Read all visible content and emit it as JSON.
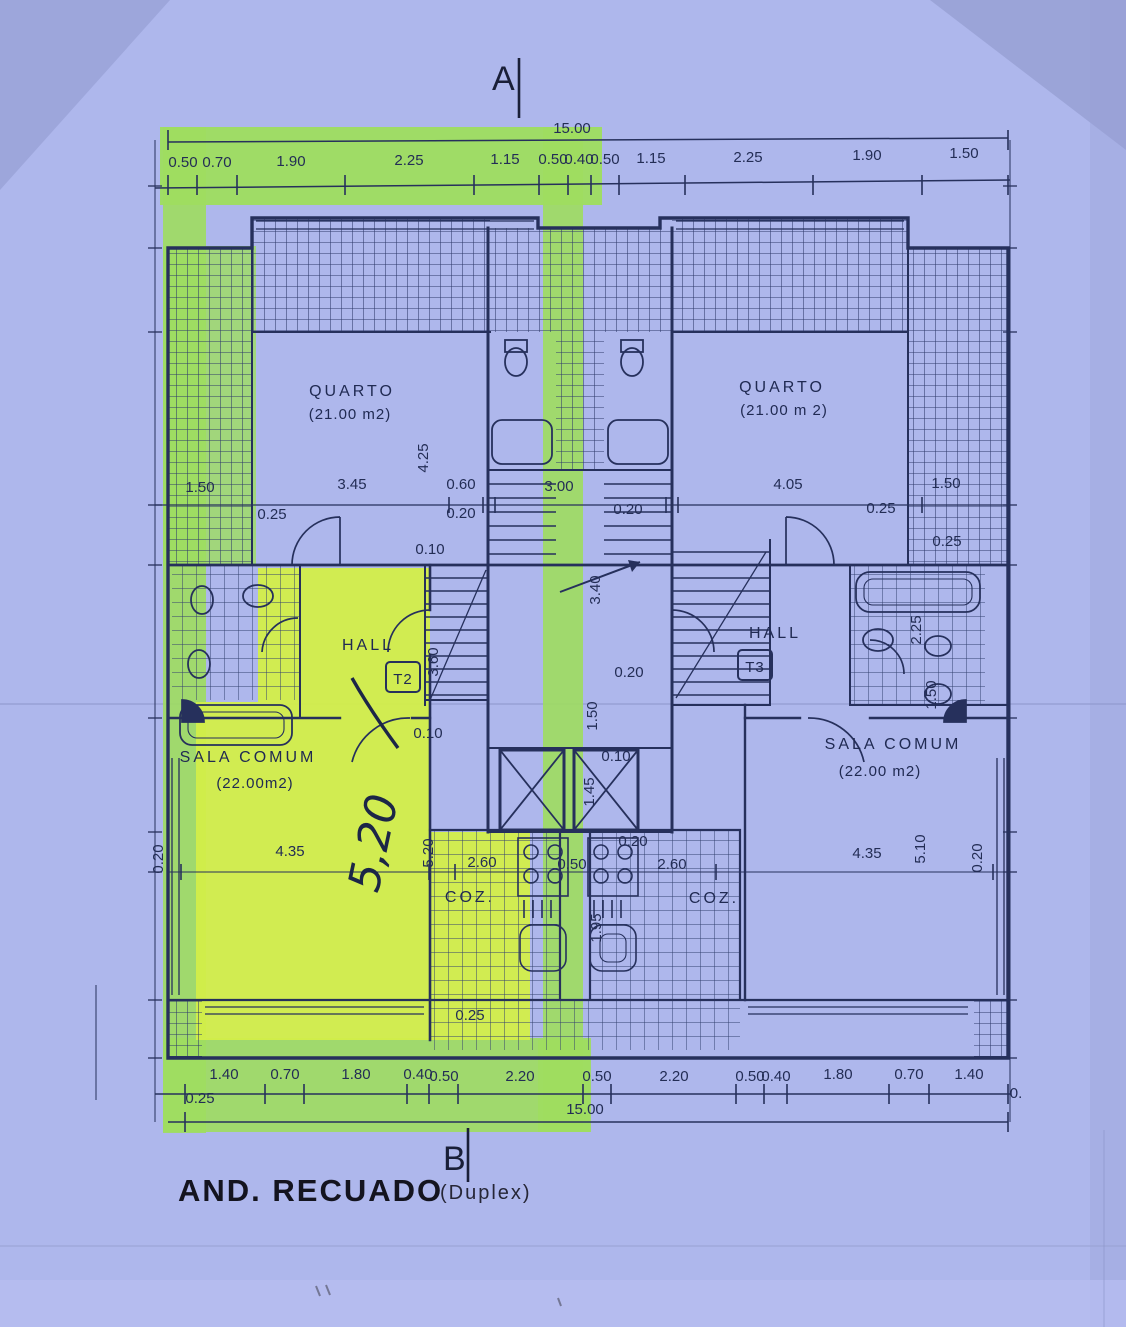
{
  "meta": {
    "drawing_title": "AND. RECUADO",
    "drawing_subtitle": "(Duplex)",
    "section_marker_top": "A",
    "section_marker_bottom": "B"
  },
  "colors": {
    "paper": "#aeb7ec",
    "ink": "#26305c",
    "title_ink": "#14141f",
    "highlighter_green": "#9edd5f",
    "highlighter_yellow": "#d3ee49"
  },
  "rooms": {
    "quarto_left": {
      "name": "QUARTO",
      "area": "(21.00 m2)"
    },
    "quarto_right": {
      "name": "QUARTO",
      "area": "(21.00 m 2)"
    },
    "hall_left": {
      "name": "HALL",
      "tag": "T2"
    },
    "hall_right": {
      "name": "HALL",
      "tag": "T3"
    },
    "sala_left": {
      "name": "SALA COMUM",
      "area": "(22.00m2)"
    },
    "sala_right": {
      "name": "SALA COMUM",
      "area": "(22.00 m2)"
    },
    "coz_left": {
      "name": "COZ."
    },
    "coz_right": {
      "name": "COZ."
    }
  },
  "handwriting": {
    "dim": "5,20"
  },
  "dims": {
    "top_total": "15.00",
    "bottom_total": "15.00",
    "labels": [
      {
        "t": "0.50",
        "x": 183,
        "y": 167,
        "fs": 14
      },
      {
        "t": "0.70",
        "x": 217,
        "y": 167,
        "fs": 14
      },
      {
        "t": "1.90",
        "x": 291,
        "y": 166
      },
      {
        "t": "2.25",
        "x": 409,
        "y": 165
      },
      {
        "t": "1.15",
        "x": 505,
        "y": 164
      },
      {
        "t": "0.50",
        "x": 553,
        "y": 164,
        "fs": 13
      },
      {
        "t": "0.40",
        "x": 579,
        "y": 164,
        "fs": 13
      },
      {
        "t": "0.50",
        "x": 605,
        "y": 164,
        "fs": 13
      },
      {
        "t": "1.15",
        "x": 651,
        "y": 163
      },
      {
        "t": "2.25",
        "x": 748,
        "y": 162
      },
      {
        "t": "1.90",
        "x": 867,
        "y": 160
      },
      {
        "t": "1.50",
        "x": 964,
        "y": 158
      },
      {
        "t": "1.50",
        "x": 200,
        "y": 492,
        "fs": 13
      },
      {
        "t": "0.25",
        "x": 272,
        "y": 519,
        "fs": 13
      },
      {
        "t": "3.45",
        "x": 352,
        "y": 489
      },
      {
        "t": "0.60",
        "x": 461,
        "y": 489,
        "fs": 13
      },
      {
        "t": "0.20",
        "x": 461,
        "y": 518,
        "fs": 13
      },
      {
        "t": "3.00",
        "x": 559,
        "y": 491
      },
      {
        "t": "0.20",
        "x": 628,
        "y": 514,
        "fs": 13
      },
      {
        "t": "4.05",
        "x": 788,
        "y": 489
      },
      {
        "t": "0.25",
        "x": 881,
        "y": 513,
        "fs": 13
      },
      {
        "t": "1.50",
        "x": 946,
        "y": 488,
        "fs": 13
      },
      {
        "t": "0.25",
        "x": 947,
        "y": 546,
        "fs": 12
      },
      {
        "t": "4.25",
        "x": 428,
        "y": 458,
        "r": -90
      },
      {
        "t": "0.10",
        "x": 430,
        "y": 554,
        "fs": 13
      },
      {
        "t": "3.40",
        "x": 600,
        "y": 590,
        "r": -90,
        "fs": 14
      },
      {
        "t": "3.60",
        "x": 438,
        "y": 662,
        "r": -90,
        "fs": 13
      },
      {
        "t": "0.20",
        "x": 629,
        "y": 677,
        "fs": 13
      },
      {
        "t": "1.50",
        "x": 597,
        "y": 716,
        "r": -90,
        "fs": 14
      },
      {
        "t": "0.10",
        "x": 616,
        "y": 761,
        "fs": 12
      },
      {
        "t": "1.45",
        "x": 594,
        "y": 792,
        "r": -90,
        "fs": 12
      },
      {
        "t": "2.25",
        "x": 921,
        "y": 630,
        "r": -90,
        "fs": 13
      },
      {
        "t": "1.50",
        "x": 936,
        "y": 695,
        "r": -90,
        "fs": 12
      },
      {
        "t": "0.10",
        "x": 428,
        "y": 738,
        "fs": 12
      },
      {
        "t": "0.20",
        "x": 163,
        "y": 859,
        "r": -90,
        "fs": 12
      },
      {
        "t": "4.35",
        "x": 290,
        "y": 856
      },
      {
        "t": "5.20",
        "x": 433,
        "y": 853,
        "r": -90,
        "fs": 13
      },
      {
        "t": "2.60",
        "x": 482,
        "y": 867,
        "fs": 14
      },
      {
        "t": "0.50",
        "x": 572,
        "y": 869,
        "fs": 12
      },
      {
        "t": "0.20",
        "x": 633,
        "y": 846,
        "fs": 12
      },
      {
        "t": "2.60",
        "x": 672,
        "y": 869,
        "fs": 14
      },
      {
        "t": "1.95",
        "x": 601,
        "y": 928,
        "r": -90,
        "fs": 12
      },
      {
        "t": "4.35",
        "x": 867,
        "y": 858
      },
      {
        "t": "5.10",
        "x": 925,
        "y": 849,
        "r": -90,
        "fs": 13
      },
      {
        "t": "0.20",
        "x": 982,
        "y": 858,
        "r": -90,
        "fs": 12
      },
      {
        "t": "0.25",
        "x": 470,
        "y": 1020,
        "fs": 13
      },
      {
        "t": "1.40",
        "x": 224,
        "y": 1079
      },
      {
        "t": "0.70",
        "x": 285,
        "y": 1079
      },
      {
        "t": "1.80",
        "x": 356,
        "y": 1079
      },
      {
        "t": "0.40",
        "x": 418,
        "y": 1079,
        "fs": 13
      },
      {
        "t": "0.50",
        "x": 444,
        "y": 1081,
        "fs": 13
      },
      {
        "t": "2.20",
        "x": 520,
        "y": 1081
      },
      {
        "t": "0.50",
        "x": 597,
        "y": 1081,
        "fs": 13
      },
      {
        "t": "2.20",
        "x": 674,
        "y": 1081
      },
      {
        "t": "0.50",
        "x": 750,
        "y": 1081,
        "fs": 13
      },
      {
        "t": "0.40",
        "x": 776,
        "y": 1081,
        "fs": 13
      },
      {
        "t": "1.80",
        "x": 838,
        "y": 1079
      },
      {
        "t": "0.70",
        "x": 909,
        "y": 1079
      },
      {
        "t": "1.40",
        "x": 969,
        "y": 1079
      },
      {
        "t": "0.25",
        "x": 200,
        "y": 1103,
        "fs": 13
      },
      {
        "t": "0.",
        "x": 1016,
        "y": 1098,
        "fs": 12
      }
    ]
  }
}
